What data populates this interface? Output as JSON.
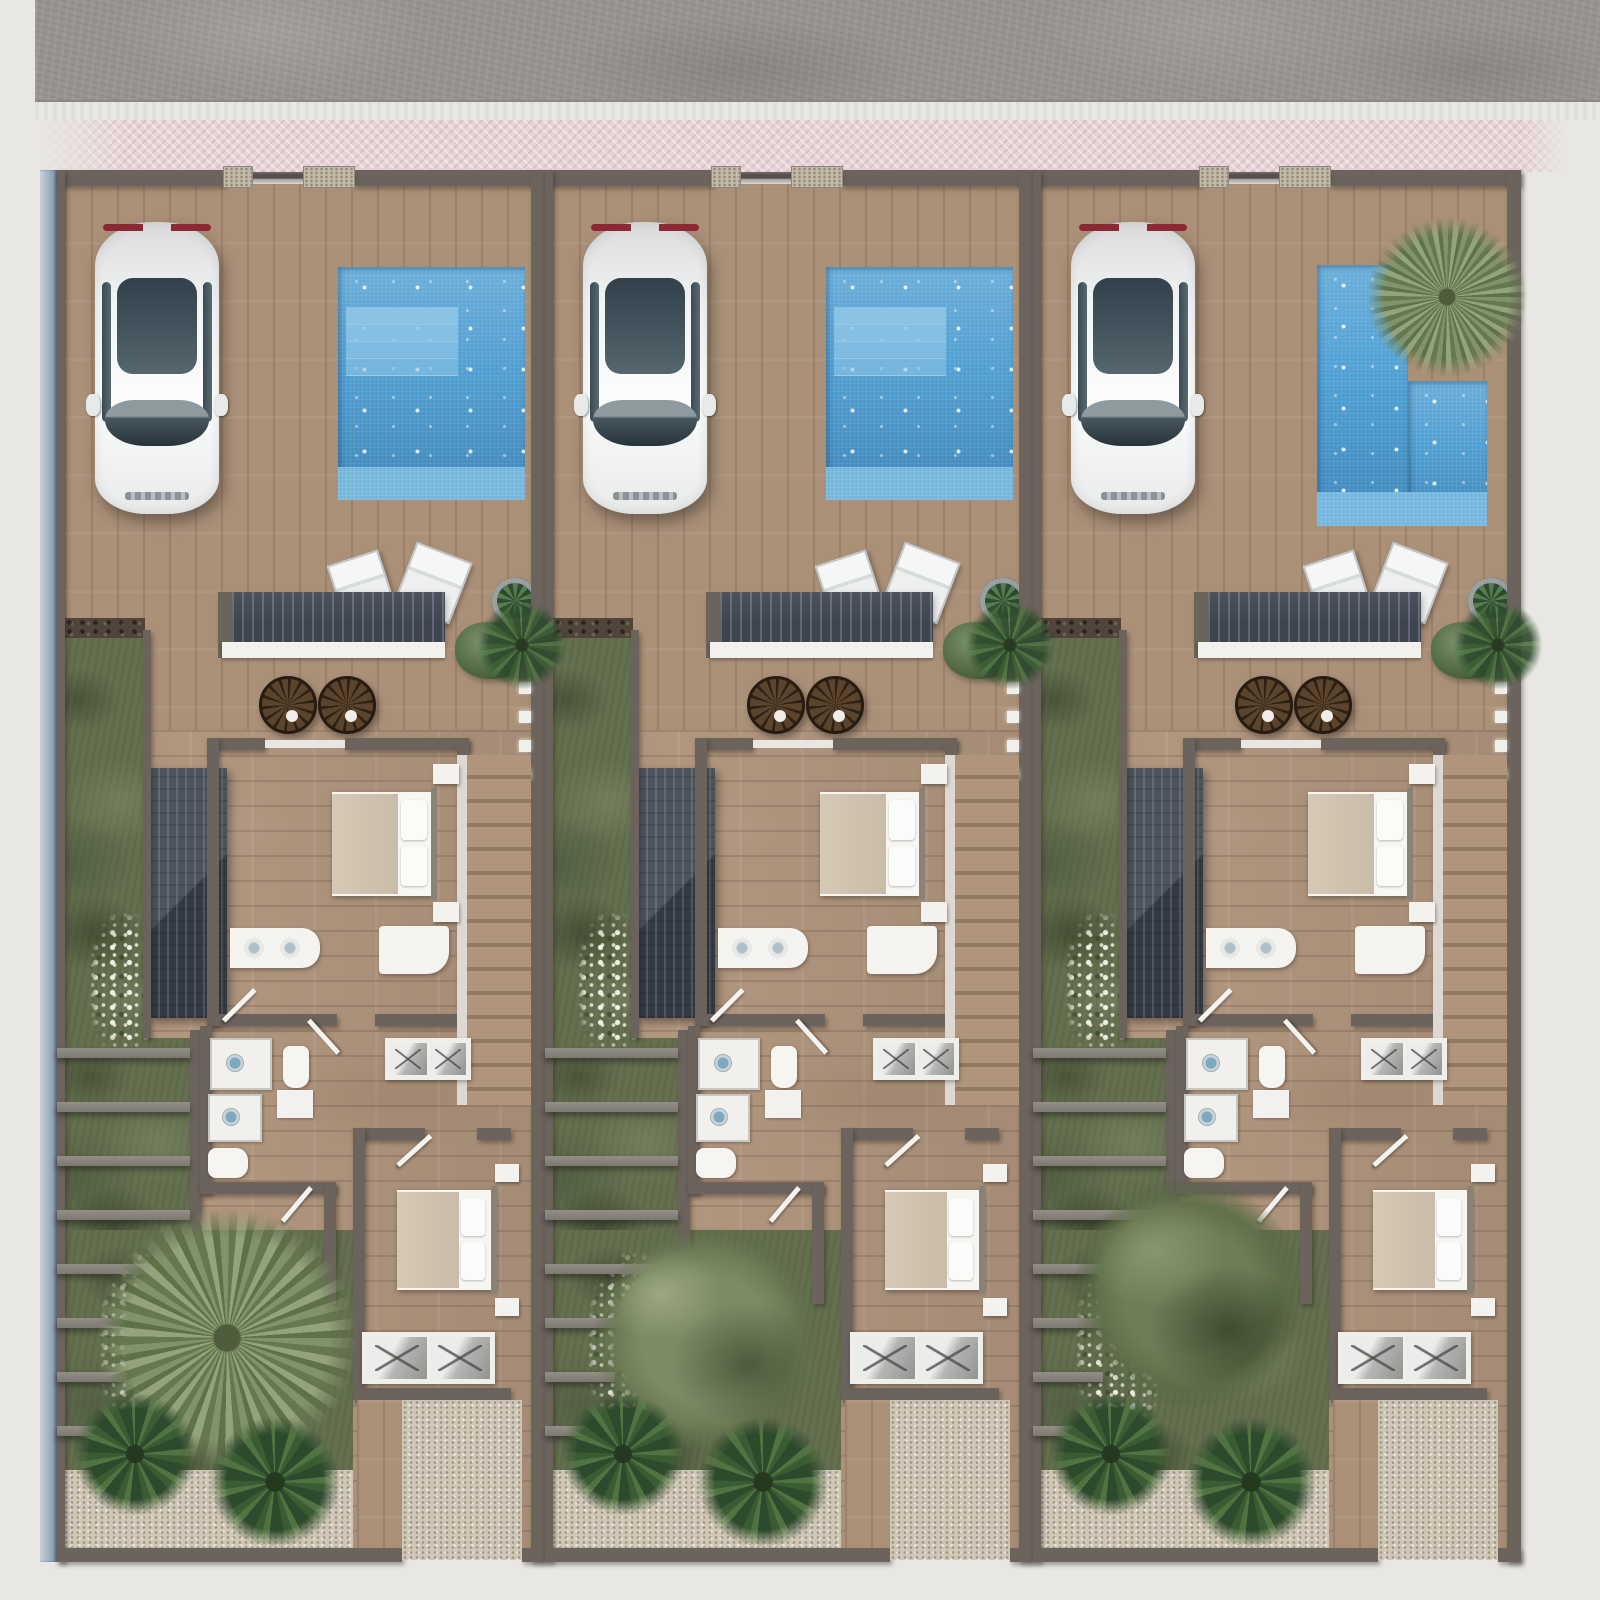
{
  "meta": {
    "type": "architectural-site-plan-render",
    "view": "top-down"
  },
  "colors": {
    "ground": "#e8e7e4",
    "road": "#989491",
    "curb": "#eae8e5",
    "sidewalk_pink": "#e7d4d8",
    "wall": "#6b635c",
    "outer_wall_blue": "#9fb0c0",
    "floor_wood": "#b2977f",
    "pool_water": "#4f9fd3",
    "pool_shallow": "#74b6dd",
    "pool_step": "#8ec5e6",
    "grass": "#64704f",
    "soil": "#51443a",
    "gravel": "#d0c7b7",
    "pergola_slate": "#3e4450",
    "stair_wood": "#a98f77",
    "fixture_white": "#f2f1ee",
    "bed_blanket": "#cfc2ae",
    "papasan_brown": "#4c3926",
    "palm_green": "#8b9c74",
    "olive_green": "#7c8a65",
    "banana_green": "#35522f",
    "car_body": "#f2f3f4",
    "car_glass": "#31404a",
    "car_taillight": "#8c2833"
  },
  "site": {
    "road_name": "asphalt-street",
    "curb_name": "street-curb",
    "sidewalk_name": "pink-paved-sidewalk",
    "left_boundary_name": "blue-gray-boundary-wall",
    "units": [
      {
        "id": "unit-1",
        "pool": "rectangular-with-steps",
        "pool_palm": false,
        "bottom_tree": "palm",
        "car": true
      },
      {
        "id": "unit-2",
        "pool": "rectangular-with-steps",
        "pool_palm": false,
        "bottom_tree": "olive",
        "car": true
      },
      {
        "id": "unit-3",
        "pool": "l-shaped",
        "pool_palm": true,
        "bottom_tree": "bush",
        "car": true
      }
    ],
    "per_unit_objects": [
      "front-wall-with-stone-gate-pillars",
      "parked-car",
      "swimming-pool",
      "sun-lounger",
      "sun-lounger",
      "pergola-roof",
      "potted-plant",
      "shrub",
      "papasan-chair",
      "papasan-chair",
      "side-garden-strip",
      "soil-planting-strip",
      "sloped-stair-roof",
      "master-bed",
      "nightstand",
      "nightstand",
      "double-sink-vanity",
      "dresser",
      "mirrored-wardrobe",
      "shower",
      "shower",
      "toilet",
      "toilet",
      "washbasin",
      "interior-staircase",
      "wall-lights",
      "guest-bed",
      "mirrored-wardrobe",
      "pergola-beams-over-garden",
      "flower-patch",
      "banana-plants",
      "gravel-patio",
      "wood-path",
      "lower-garden"
    ],
    "counts": {
      "units": 3,
      "cars": 3,
      "pools": 3,
      "papasan_chairs_per_unit": 2,
      "loungers_per_unit": 2,
      "beds_per_unit": 2,
      "wall_lights_per_unit": 4,
      "garden_beams_per_unit": 8
    }
  }
}
